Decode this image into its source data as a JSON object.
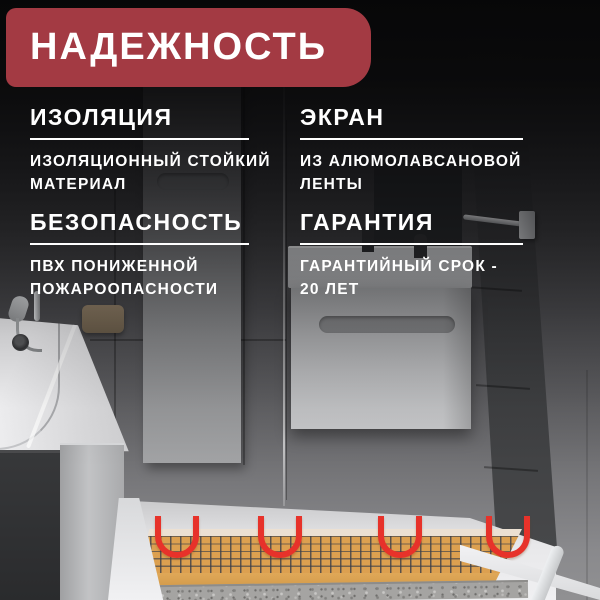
{
  "banner": {
    "label": "НАДЕЖНОСТЬ"
  },
  "features": [
    {
      "title": "ИЗОЛЯЦИЯ",
      "line1": "ИЗОЛЯЦИОННЫЙ СТОЙКИЙ",
      "line2": "МАТЕРИАЛ"
    },
    {
      "title": "ЭКРАН",
      "line1": "ИЗ АЛЮМОЛАВСАНОВОЙ",
      "line2": "ЛЕНТЫ"
    },
    {
      "title": "БЕЗОПАСНОСТЬ",
      "line1": "ПВХ ПОНИЖЕННОЙ",
      "line2": "ПОЖАРООПАСНОСТИ"
    },
    {
      "title": "ГАРАНТИЯ",
      "line1": "ГАРАНТИЙНЫЙ СРОК -",
      "line2": "20 ЛЕТ"
    }
  ],
  "colors": {
    "banner_red": "#a33a43",
    "text_white": "#ffffff",
    "heating_mat_tan": "#dca050",
    "cable_red": "#e7322a",
    "mesh_gray": "#3a3f4a"
  }
}
